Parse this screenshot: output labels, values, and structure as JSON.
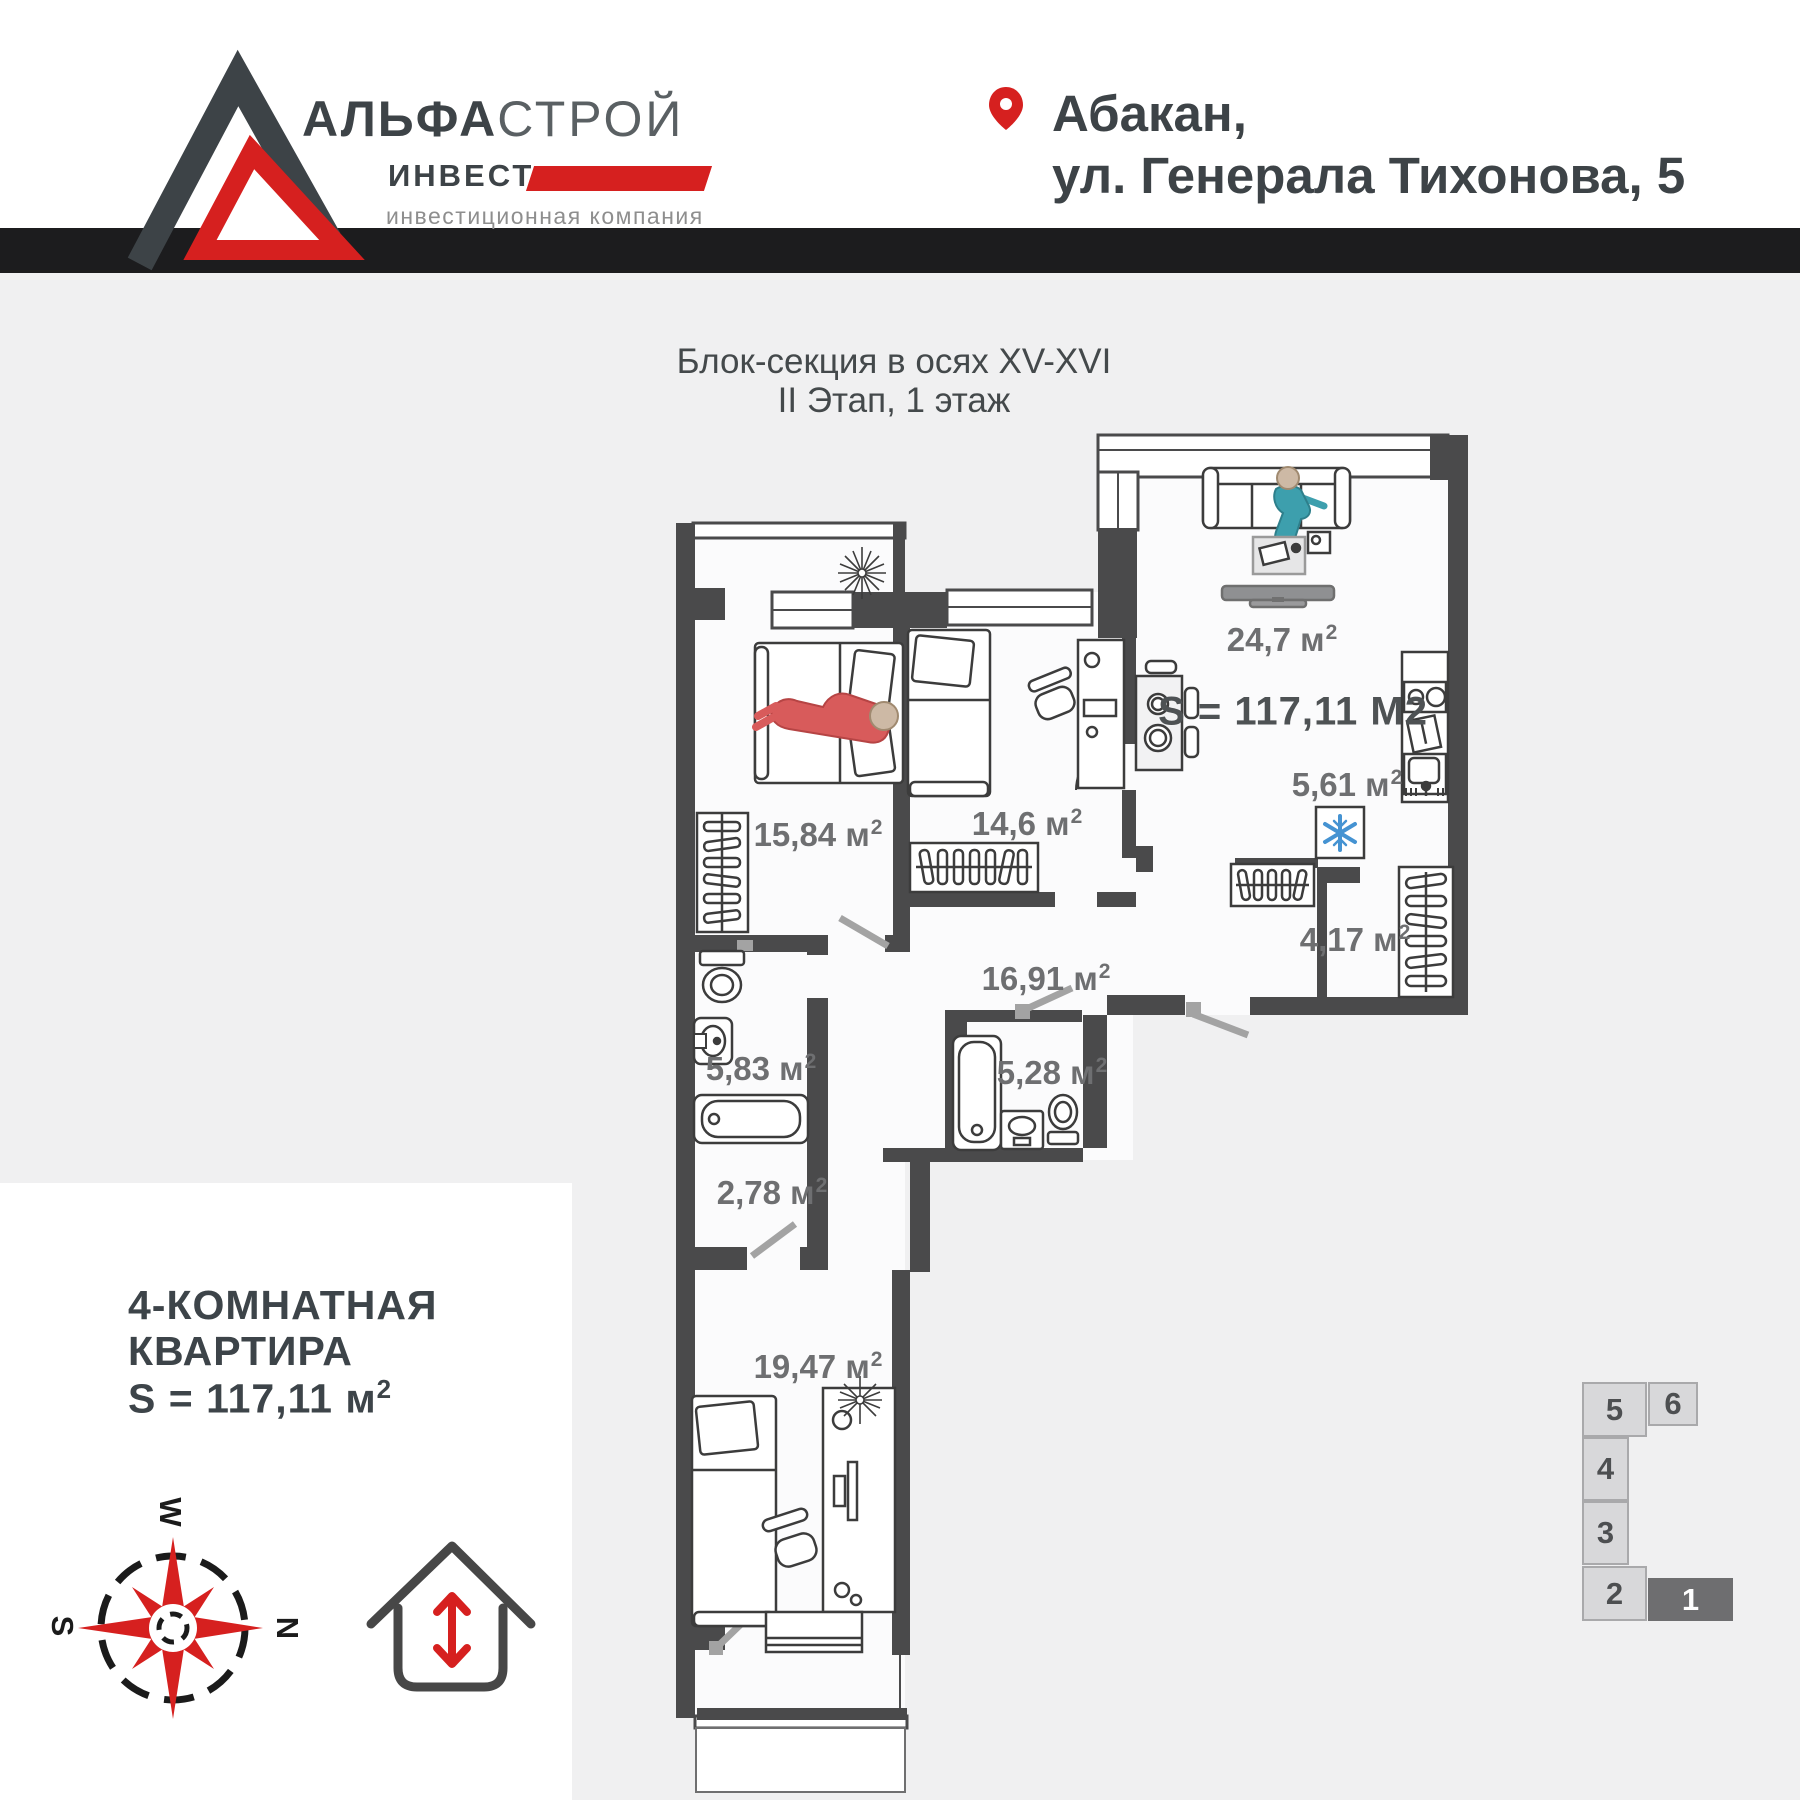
{
  "header": {
    "logo": {
      "name_bold": "АЛЬФА",
      "name_light": "СТРОЙ",
      "line2": "ИНВЕСТ",
      "tagline": "инвестиционная компания"
    },
    "location": {
      "line1": "Абакан,",
      "line2": "ул. Генерала Тихонова, 5"
    }
  },
  "plan": {
    "title_line1": "Блок-секция в осях XV-XVI",
    "title_line2": "II Этап, 1 этаж",
    "total_area_label": "S = 117,11 М2",
    "rooms": [
      {
        "id": "living-room",
        "value": "24,7 м",
        "sup": "2"
      },
      {
        "id": "kitchen",
        "value": "5,61 м",
        "sup": "2"
      },
      {
        "id": "wardrobe",
        "value": "4,17 м",
        "sup": "2"
      },
      {
        "id": "corridor",
        "value": "16,91 м",
        "sup": "2"
      },
      {
        "id": "bedroom-2",
        "value": "14,6 м",
        "sup": "2"
      },
      {
        "id": "bedroom-1",
        "value": "15,84 м",
        "sup": "2"
      },
      {
        "id": "bathroom-1",
        "value": "5,83 м",
        "sup": "2"
      },
      {
        "id": "bathroom-2",
        "value": "5,28 м",
        "sup": "2"
      },
      {
        "id": "closet",
        "value": "2,78 м",
        "sup": "2"
      },
      {
        "id": "bedroom-3",
        "value": "19,47 м",
        "sup": "2"
      }
    ]
  },
  "info_box": {
    "title_line1": "4-КОМНАТНАЯ",
    "title_line2": "КВАРТИРА",
    "area_value": "S = 117,11 м",
    "area_sup": "2",
    "compass": {
      "top": "W",
      "left": "S",
      "right": "N"
    }
  },
  "site_plan": {
    "cells": [
      {
        "label": "5"
      },
      {
        "label": "6"
      },
      {
        "label": "4"
      },
      {
        "label": "3"
      },
      {
        "label": "2"
      },
      {
        "label": "1"
      }
    ]
  },
  "colors": {
    "accent_red": "#d6201f",
    "wall_dark": "#4a4a4b",
    "divider": "#1c1c1e",
    "label_gray": "#6e6f71",
    "fridge_blue": "#4593d2",
    "person_teal": "#3d9fad",
    "person_red": "#d85b5b"
  }
}
